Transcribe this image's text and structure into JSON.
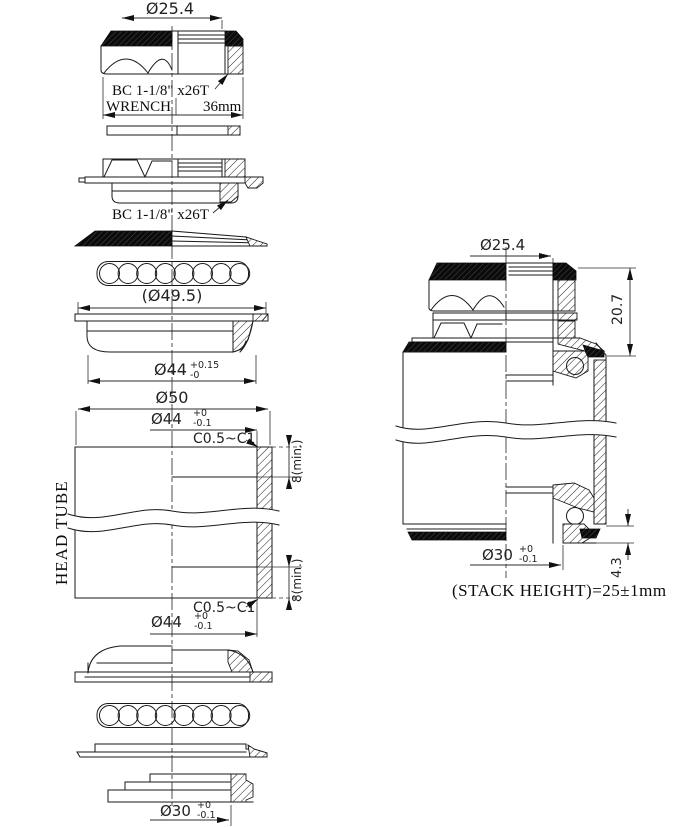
{
  "title": "Threaded headset technical drawing",
  "left_view": {
    "locknut": {
      "dim_od": "Ø25.4",
      "thread_label": "BC 1-1/8\" x26T",
      "wrench_label": "WRENCH",
      "wrench_size": "36mm"
    },
    "adjustable_cup": {
      "thread_label": "BC 1-1/8\" x26T"
    },
    "ball_retainer": {
      "dim_ball_circle": "(Ø49.5)"
    },
    "upper_cup": {
      "dim_od": "Ø44",
      "tol_plus": "+0.15",
      "tol_minus": "-0"
    },
    "head_tube": {
      "label": "HEAD TUBE",
      "dim_od": "Ø50",
      "bore_top": {
        "dim": "Ø44",
        "tol_plus": "+0",
        "tol_minus": "-0.1",
        "chamfer": "C0.5~C1",
        "depth": "8(min.)"
      },
      "bore_bottom": {
        "dim": "Ø44",
        "tol_plus": "+0",
        "tol_minus": "-0.1",
        "chamfer": "C0.5~C1",
        "depth": "8(min.)"
      }
    },
    "crown_race": {
      "dim_bore": "Ø30",
      "tol_plus": "+0",
      "tol_minus": "-0.1"
    }
  },
  "right_view": {
    "dim_steerer": "Ø25.4",
    "dim_upper_stack": "20.7",
    "crown": {
      "dim_bore": "Ø30",
      "tol_plus": "+0",
      "tol_minus": "-0.1"
    },
    "dim_lower_stack": "4.3",
    "stack_height_note": "(STACK HEIGHT)=25±1mm"
  }
}
